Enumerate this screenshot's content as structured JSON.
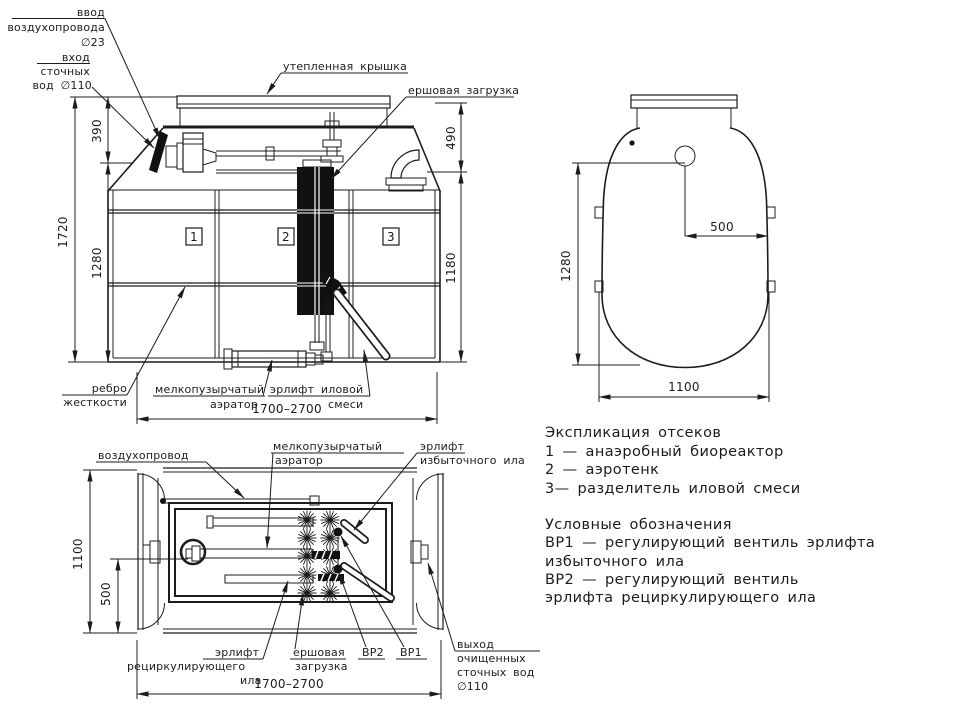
{
  "colors": {
    "line": "#1c1c1c",
    "background": "#ffffff"
  },
  "front_view": {
    "air_inlet": [
      "ввод",
      "воздухопровода",
      "∅23"
    ],
    "sewage_inlet": [
      "вход",
      "сточных",
      "вод ∅110"
    ],
    "cover_label": "утепленная крышка",
    "brush_label": "ершовая загрузка",
    "rib": [
      "ребро",
      "жесткости"
    ],
    "aerator": [
      "мелкопузырчатый",
      "аэратор"
    ],
    "sludge_airlift": [
      "эрлифт иловой",
      "смеси"
    ],
    "compartments": [
      "1",
      "2",
      "3"
    ],
    "dims": {
      "total_height": "1720",
      "inlet_depth": "390",
      "body_height": "1280",
      "outlet_depth": "490",
      "lower_height": "1180",
      "length": "1700–2700"
    }
  },
  "top_view": {
    "dims": {
      "height": "1280",
      "offset": "500",
      "width": "1100"
    }
  },
  "plan_view": {
    "air_pipe": "воздухопровод",
    "aerator": [
      "мелкопузырчатый",
      "аэратор"
    ],
    "excess_airlift": [
      "эрлифт",
      "избыточного ила"
    ],
    "recirc_airlift": [
      "эрлифт",
      "рециркулирующего",
      "ила"
    ],
    "brush": [
      "ершовая",
      "загрузка"
    ],
    "valve2": "ВР2",
    "valve1": "ВР1",
    "outlet": [
      "выход",
      "очищенных",
      "сточных вод",
      "∅110"
    ],
    "dims": {
      "width": "1100",
      "offset": "500",
      "length": "1700–2700"
    }
  },
  "legend": {
    "lines": [
      "Экспликация отсеков",
      "1 —  анаэробный биореактор",
      "2 —  аэротенк",
      "3—  разделитель иловой смеси",
      "Условные обозначения",
      "ВР1 —  регулирующий вентиль эрлифта",
      "избыточного ила",
      "ВР2 —  регулирующий вентиль",
      "эрлифта рециркулирующего ила"
    ]
  }
}
